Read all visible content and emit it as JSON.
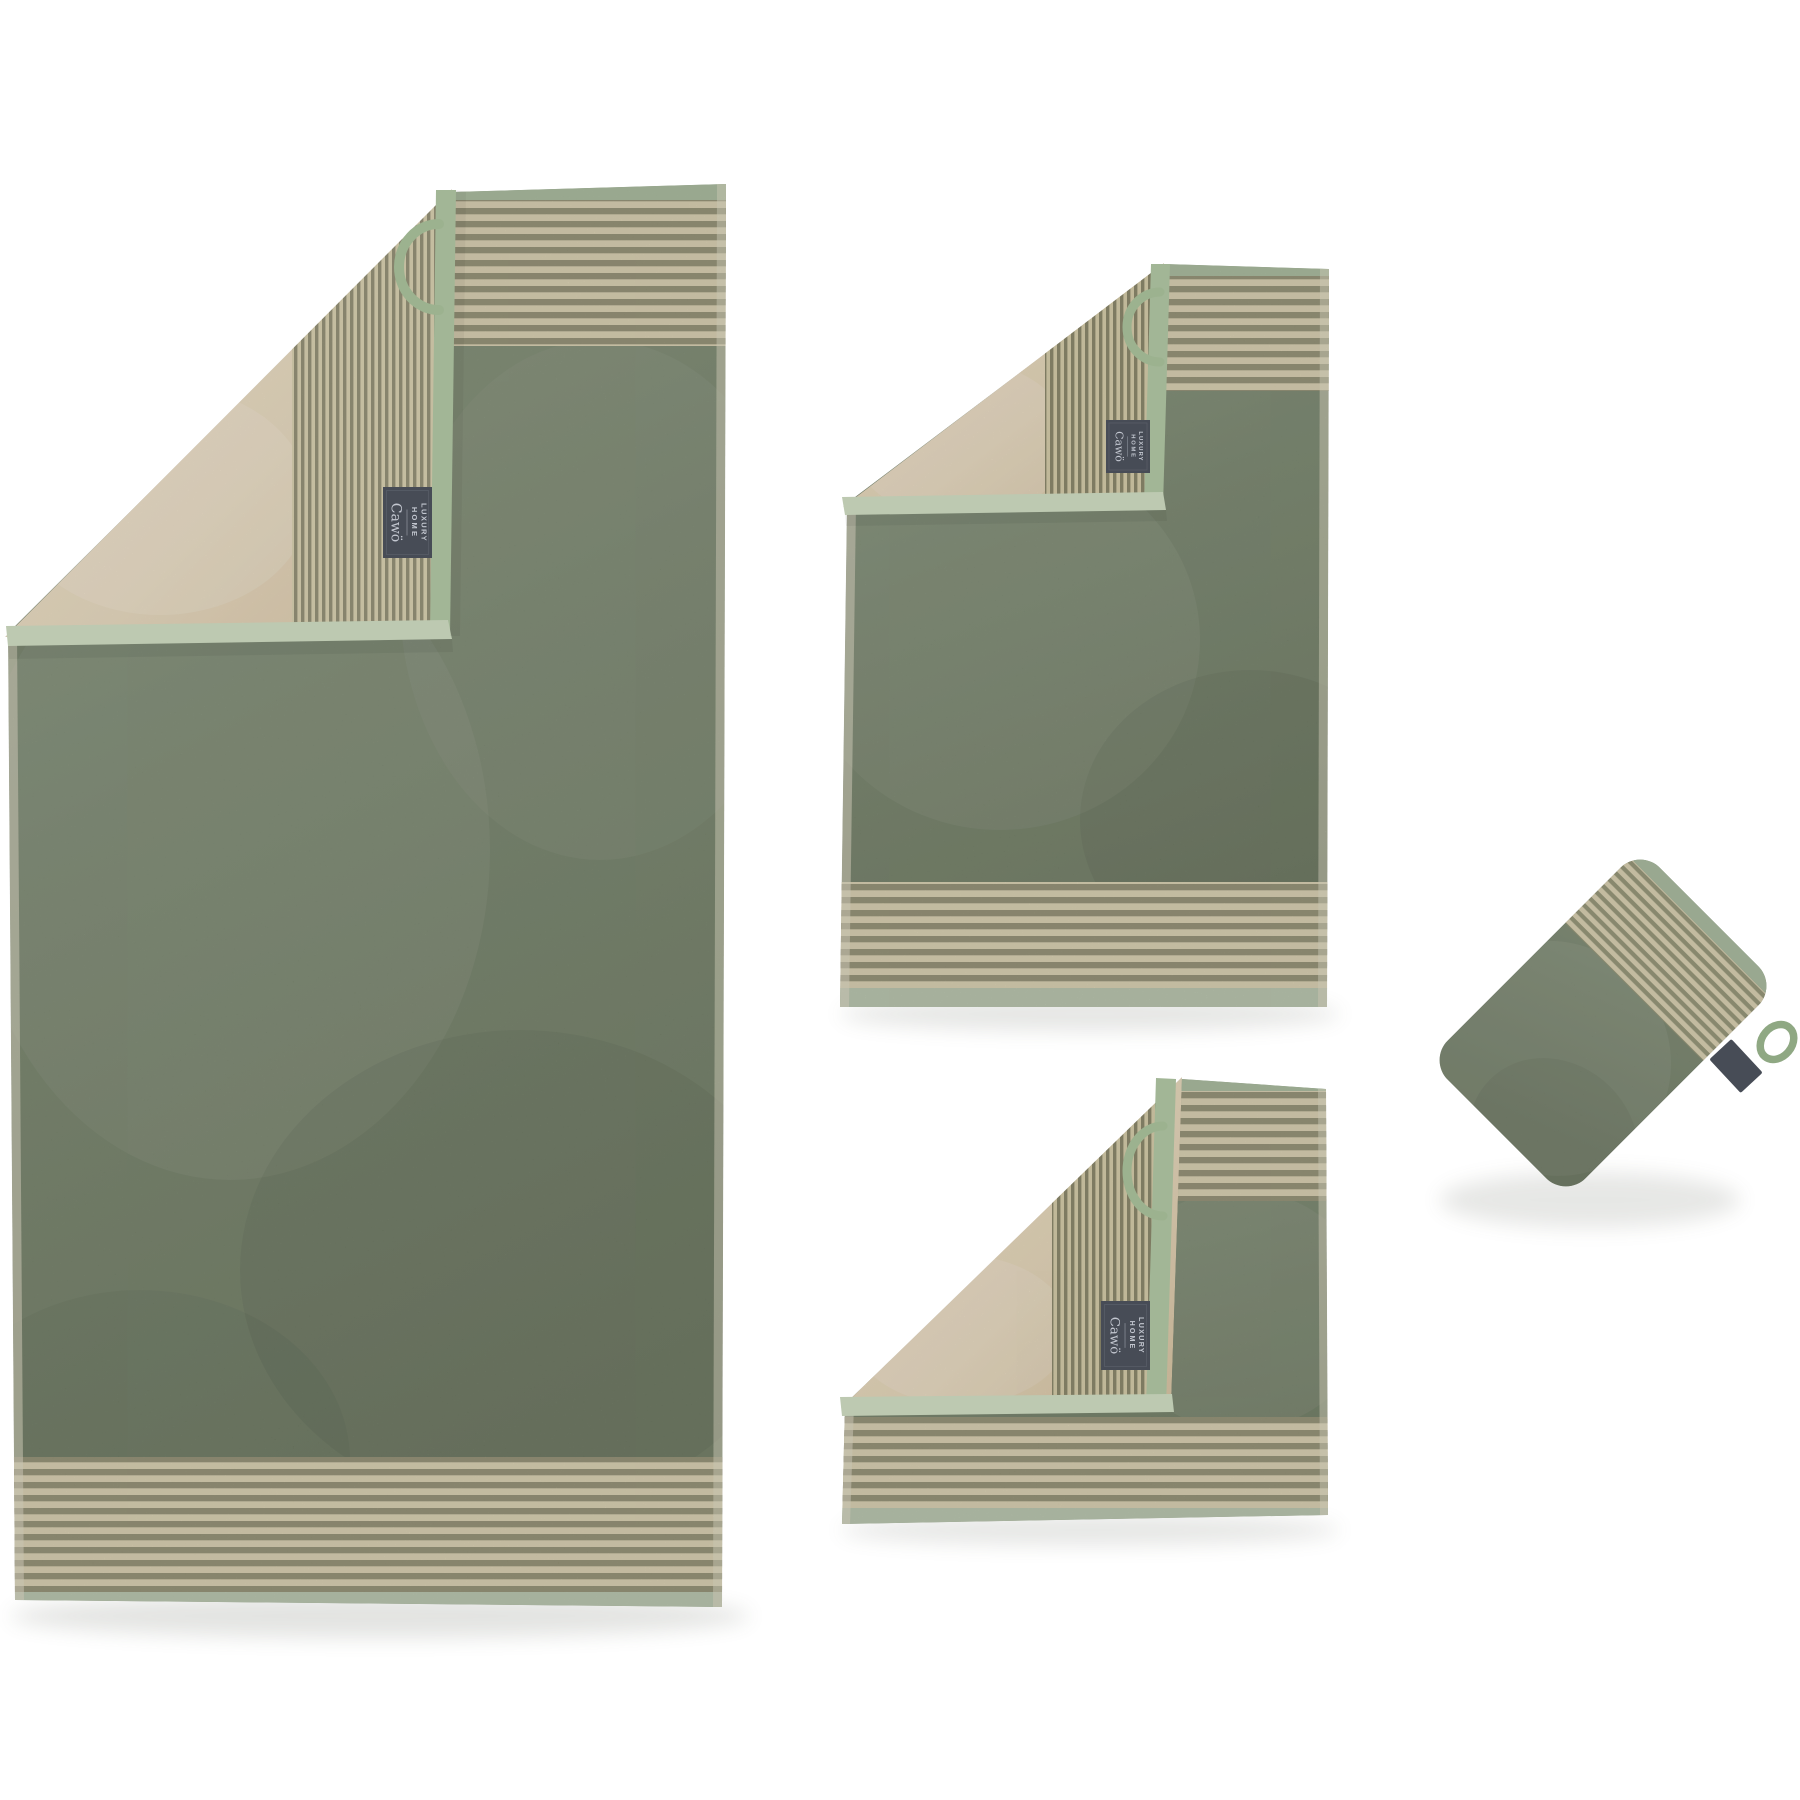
{
  "image": {
    "type": "product-photo",
    "background": "#ffffff",
    "description": "Two-tone terry towel set in field green with beige reverse: bath towel, hand towel, washcloth and wash mitt, each with a striped border, folded corner, hanging loop and woven brand label"
  },
  "label": {
    "line1": "LUXURY",
    "line2": "HOME",
    "brand": "Cawö"
  },
  "colors": {
    "background": "#ffffff",
    "towel_green": "#75836a",
    "towel_green_light": "#87947a",
    "towel_green_dark": "#6b785e",
    "reverse_beige": "#e5d6ba",
    "stripe_cream": "#d8cfae",
    "stripe_olive": "#8f8c6f",
    "border_sage": "#a3b795",
    "hem_pale": "#b9c6ab",
    "selvedge_pale": "#e0dbc4",
    "label_bg": "#474c56",
    "label_text": "#c3c7d0",
    "loop_green": "#9cb28f"
  },
  "items": [
    {
      "name": "bath-towel"
    },
    {
      "name": "hand-towel"
    },
    {
      "name": "washcloth"
    },
    {
      "name": "wash-mitt"
    }
  ]
}
